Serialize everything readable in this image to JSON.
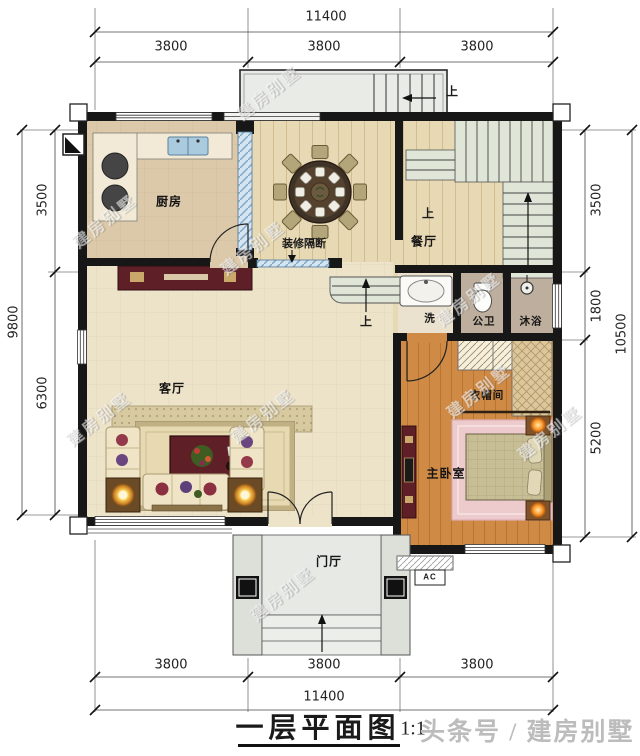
{
  "title_block": {
    "caption": "一层平面图",
    "scale": "1:1",
    "watermark_caption": "头条号 / 建房别墅"
  },
  "watermark_text": "建房别墅",
  "dimensions": {
    "top": {
      "total": "11400",
      "segments": [
        "3800",
        "3800",
        "3800"
      ]
    },
    "bottom": {
      "total": "11400",
      "segments": [
        "3800",
        "3800",
        "3800"
      ]
    },
    "left": {
      "total": "9800",
      "segments": [
        "3500",
        "6300"
      ]
    },
    "right": {
      "total": "10500",
      "segments": [
        "3500",
        "1800",
        "5200"
      ]
    }
  },
  "rooms": {
    "kitchen": "厨房",
    "dining": "餐厅",
    "living": "客厅",
    "master_bedroom": "主卧室",
    "cloakroom": "衣帽间",
    "wash": "洗",
    "toilet": "公卫",
    "shower": "沐浴",
    "foyer": "门厅"
  },
  "annotations": {
    "partition": "装修隔断",
    "up_balcony": "上",
    "up_stairs": "上",
    "up_steps": "上",
    "ac": "AC"
  },
  "colors": {
    "wall": "#171717",
    "wood_floor": "#e8d9b5",
    "living_floor": "#ede3c9",
    "bedroom_floor": "#cf8a46",
    "stair_green": "#e0e6d7",
    "accent_red": "#5e1f26",
    "rug_pink": "#edcbcd",
    "sink_blue": "#aacade",
    "glass_blue": "#d4e4f0"
  }
}
